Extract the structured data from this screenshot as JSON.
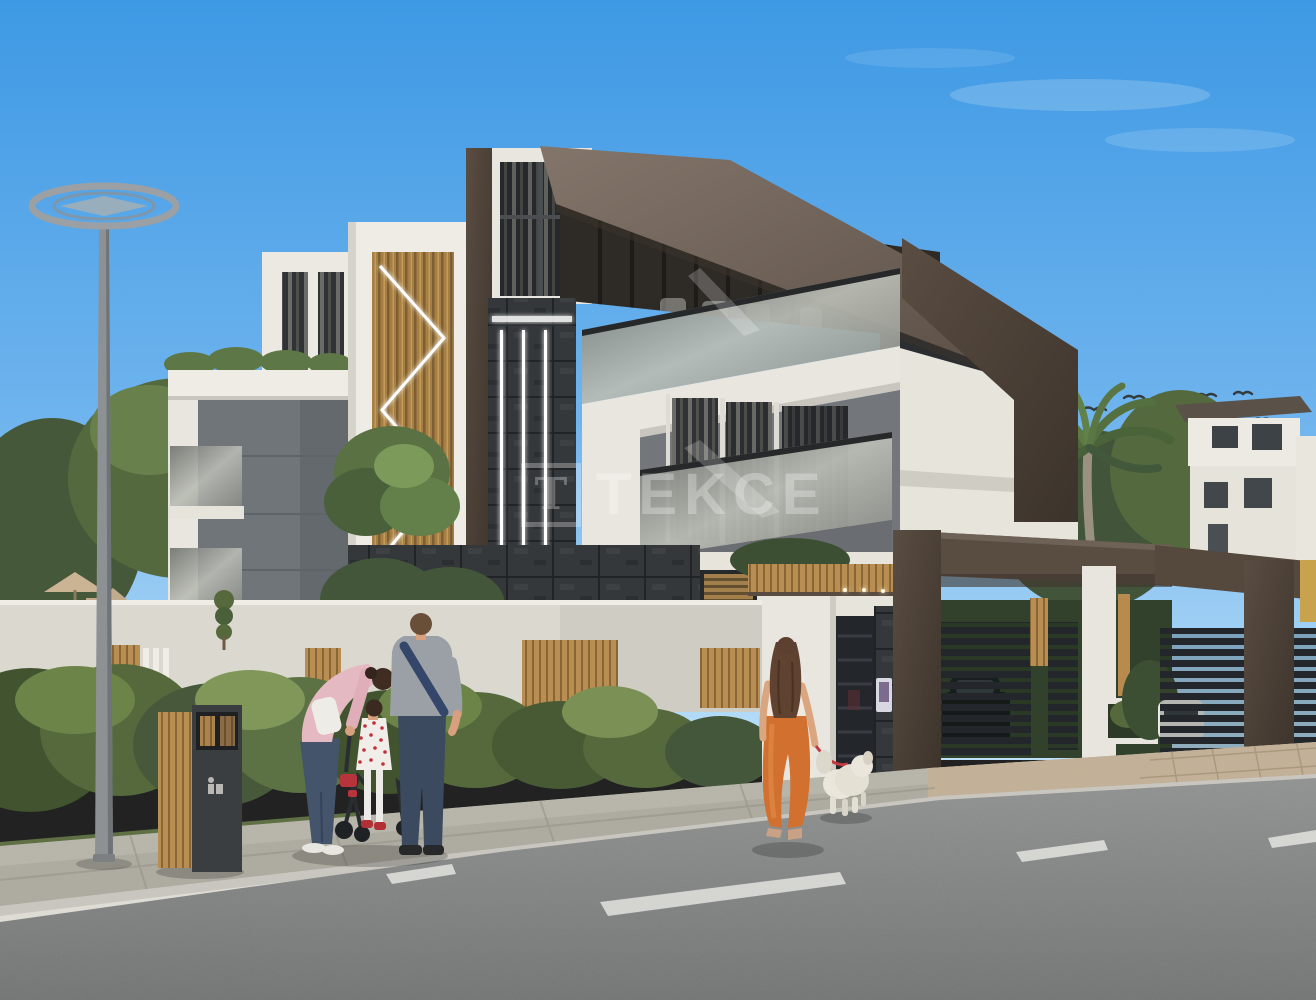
{
  "watermark": {
    "logo_letter": "T",
    "brand": "TEKCE",
    "color": "#ffffff",
    "opacity": "0.28"
  },
  "scene": {
    "subject": "modern three-storey villa exterior render",
    "setting": "sunny day, blue sky, residential street with sidewalk and asphalt road"
  },
  "palette": {
    "sky_top": "#459ee6",
    "sky_horizon": "#b7def7",
    "roof_brown": "#74665b",
    "dark_brown": "#4a3e34",
    "white_wall": "#eceae3",
    "gray_panel": "#75797d",
    "dark_stone": "#34383a",
    "wood": "#b2874c",
    "hedge_green": "#4f6138",
    "tree_green": "#5a7243",
    "asphalt": "#8a8c8b",
    "sidewalk": "#b0aea2",
    "driveway_tile": "#c3b197",
    "glass": "#9b9e99",
    "led_white": "#ffffff",
    "orange_pants": "#d2702f",
    "pink_shirt": "#e5b9c1",
    "red_leash": "#c03a40",
    "lamp_gray": "#8d9193"
  },
  "objects": {
    "villa": "three-storey modern villa with glass balconies and LED facade strips",
    "facade_tree": "green tree growing from facade niche",
    "carport": "brown carport with slatted gates and parked cars",
    "entrance": "pedestrian gate with wood canopy and intercom",
    "street_lamp": "ring-top street lamp",
    "litter_bin": "wood and metal litter bin",
    "family_group": "man, woman and child with stroller on sidewalk",
    "dog_walker": "woman in orange pants walking white dog on red leash",
    "birds": "birds flying near palm tree",
    "road_markings": "dashed white lane lines"
  }
}
